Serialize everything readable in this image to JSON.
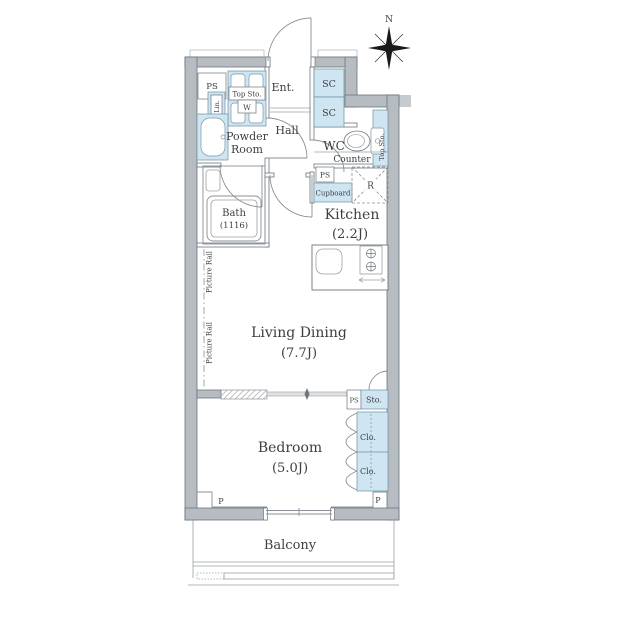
{
  "colors": {
    "wall_fill": "#b6bcc1",
    "wall_stroke": "#6e757b",
    "line": "#8a9096",
    "fixture_fill": "#cfe6f2",
    "fixture_stroke": "#6b8fa3",
    "text": "#3b4045"
  },
  "compass": {
    "north_label": "N"
  },
  "rooms": {
    "entrance": {
      "label": "Ent."
    },
    "hall": {
      "label": "Hall"
    },
    "powder_room": {
      "line1": "Powder",
      "line2": "Room"
    },
    "wc": {
      "label": "WC"
    },
    "bath": {
      "line1": "Bath",
      "line2": "(1116)"
    },
    "kitchen": {
      "line1": "Kitchen",
      "line2": "(2.2J)"
    },
    "living_dining": {
      "line1": "Living Dining",
      "line2": "(7.7J)"
    },
    "bedroom": {
      "line1": "Bedroom",
      "line2": "(5.0J)"
    },
    "balcony": {
      "label": "Balcony"
    }
  },
  "fixtures": {
    "ps_entry": "PS",
    "top_storage_washer": "Top Sto.",
    "washer": "W",
    "linen": "Lin.",
    "shoe_cabinet_1": "SC",
    "shoe_cabinet_2": "SC",
    "wc_top_storage": "Top Sto.",
    "counter": "Counter",
    "ps_kitchen": "PS",
    "cupboard": "Cupboard",
    "refrigerator": "R",
    "picture_rail_1": "Picture Rail",
    "picture_rail_2": "Picture Rail",
    "ps_bedroom": "PS",
    "storage": "Sto.",
    "closet_1": "Clo.",
    "closet_2": "Clo.",
    "pillar_left": "P",
    "pillar_right": "P"
  }
}
